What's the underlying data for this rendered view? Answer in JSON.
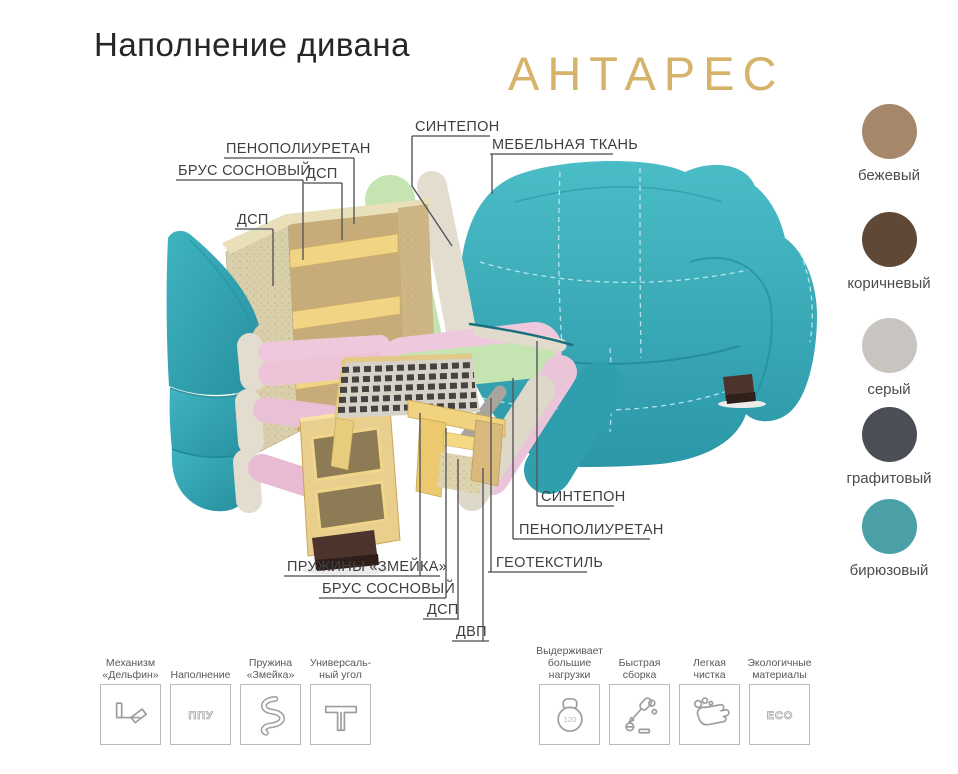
{
  "header": {
    "title": "Наполнение дивана",
    "product_name": "АНТАРЕС"
  },
  "palette": {
    "brand_gold": "#d5b36b",
    "title_text": "#262626",
    "label_text": "#3e3f42",
    "sofa_turquoise": "#36aebc",
    "foam_green": "#c6e3b2",
    "foam_pink": "#eec9dd",
    "sintepon_cream": "#e2ddcf",
    "wood": "#f2d584",
    "chipboard": "#d9d0ab",
    "springs_dark": "#45433f",
    "foot_brown": "#4c332c"
  },
  "diagram": {
    "labels": [
      {
        "id": "sintepon-top",
        "text": "СИНТЕПОН"
      },
      {
        "id": "mebelnaya-tkan",
        "text": "МЕБЕЛЬНАЯ ТКАНЬ"
      },
      {
        "id": "penopoliuretan-top",
        "text": "ПЕНОПОЛИУРЕТАН"
      },
      {
        "id": "brus-sosnovy-top",
        "text": "БРУС СОСНОВЫЙ"
      },
      {
        "id": "dsp-top",
        "text": "ДСП"
      },
      {
        "id": "dsp-left",
        "text": "ДСП"
      },
      {
        "id": "sintepon-seat",
        "text": "СИНТЕПОН"
      },
      {
        "id": "penopoliuretan-seat",
        "text": "ПЕНОПОЛИУРЕТАН"
      },
      {
        "id": "geotekstil",
        "text": "ГЕОТЕКСТИЛЬ"
      },
      {
        "id": "pruzhiny-zmeyka",
        "text": "ПРУЖИНЫ «ЗМЕЙКА»"
      },
      {
        "id": "brus-sosnovy-bottom",
        "text": "БРУС СОСНОВЫЙ"
      },
      {
        "id": "dsp-bottom",
        "text": "ДСП"
      },
      {
        "id": "dvp",
        "text": "ДВП"
      }
    ]
  },
  "swatches": [
    {
      "name": "бежевый",
      "hex": "#a5886a"
    },
    {
      "name": "коричневый",
      "hex": "#5f4936"
    },
    {
      "name": "серый",
      "hex": "#c8c4bf"
    },
    {
      "name": "графитовый",
      "hex": "#4b4e54"
    },
    {
      "name": "бирюзовый",
      "hex": "#4aa0a6"
    }
  ],
  "features": [
    {
      "caption": "Механизм\n«Дельфин»",
      "icon": "sofa-mechanism-icon",
      "icon_text": ""
    },
    {
      "caption": "Наполнение",
      "icon": "ppu-foam-icon",
      "icon_text": "ППУ"
    },
    {
      "caption": "Пружина\n«Змейка»",
      "icon": "snake-spring-icon",
      "icon_text": ""
    },
    {
      "caption": "Универсаль-\nный угол",
      "icon": "universal-corner-icon",
      "icon_text": ""
    },
    {
      "caption": "Выдерживает\nбольшие\nнагрузки",
      "icon": "kettlebell-icon",
      "icon_text": "120"
    },
    {
      "caption": "Быстрая\nсборка",
      "icon": "quick-assembly-icon",
      "icon_text": ""
    },
    {
      "caption": "Легкая чистка",
      "icon": "easy-cleaning-icon",
      "icon_text": ""
    },
    {
      "caption": "Экологичные\nматериалы",
      "icon": "eco-icon",
      "icon_text": "ECO"
    }
  ]
}
